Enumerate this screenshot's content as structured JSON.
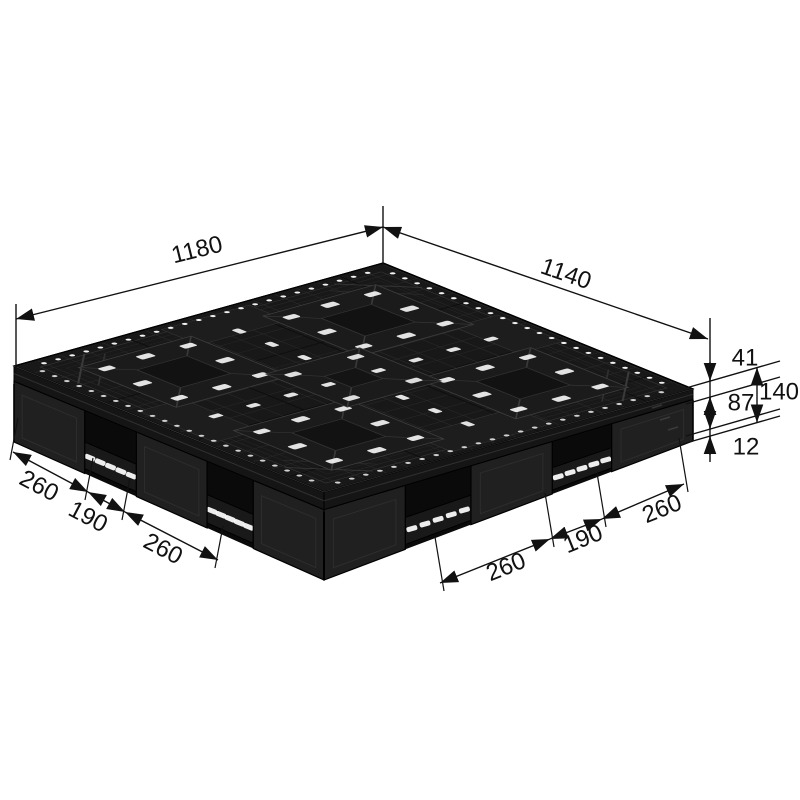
{
  "dimensions": {
    "width": {
      "label": "1180"
    },
    "depth": {
      "label": "1140"
    },
    "total_height": {
      "label": "140"
    },
    "deck_thickness": {
      "label": "41"
    },
    "fork_clearance": {
      "label": "87"
    },
    "bottom_deck_thickness": {
      "label": "12"
    },
    "left_segments": [
      {
        "label": "260"
      },
      {
        "label": "190"
      },
      {
        "label": "260"
      }
    ],
    "right_segments": [
      {
        "label": "260"
      },
      {
        "label": "190"
      },
      {
        "label": "260"
      }
    ]
  },
  "colors": {
    "background": "#ffffff",
    "pallet_body": "#181818",
    "dimension_ink": "#111111",
    "hole_highlight": "#ffffff"
  }
}
